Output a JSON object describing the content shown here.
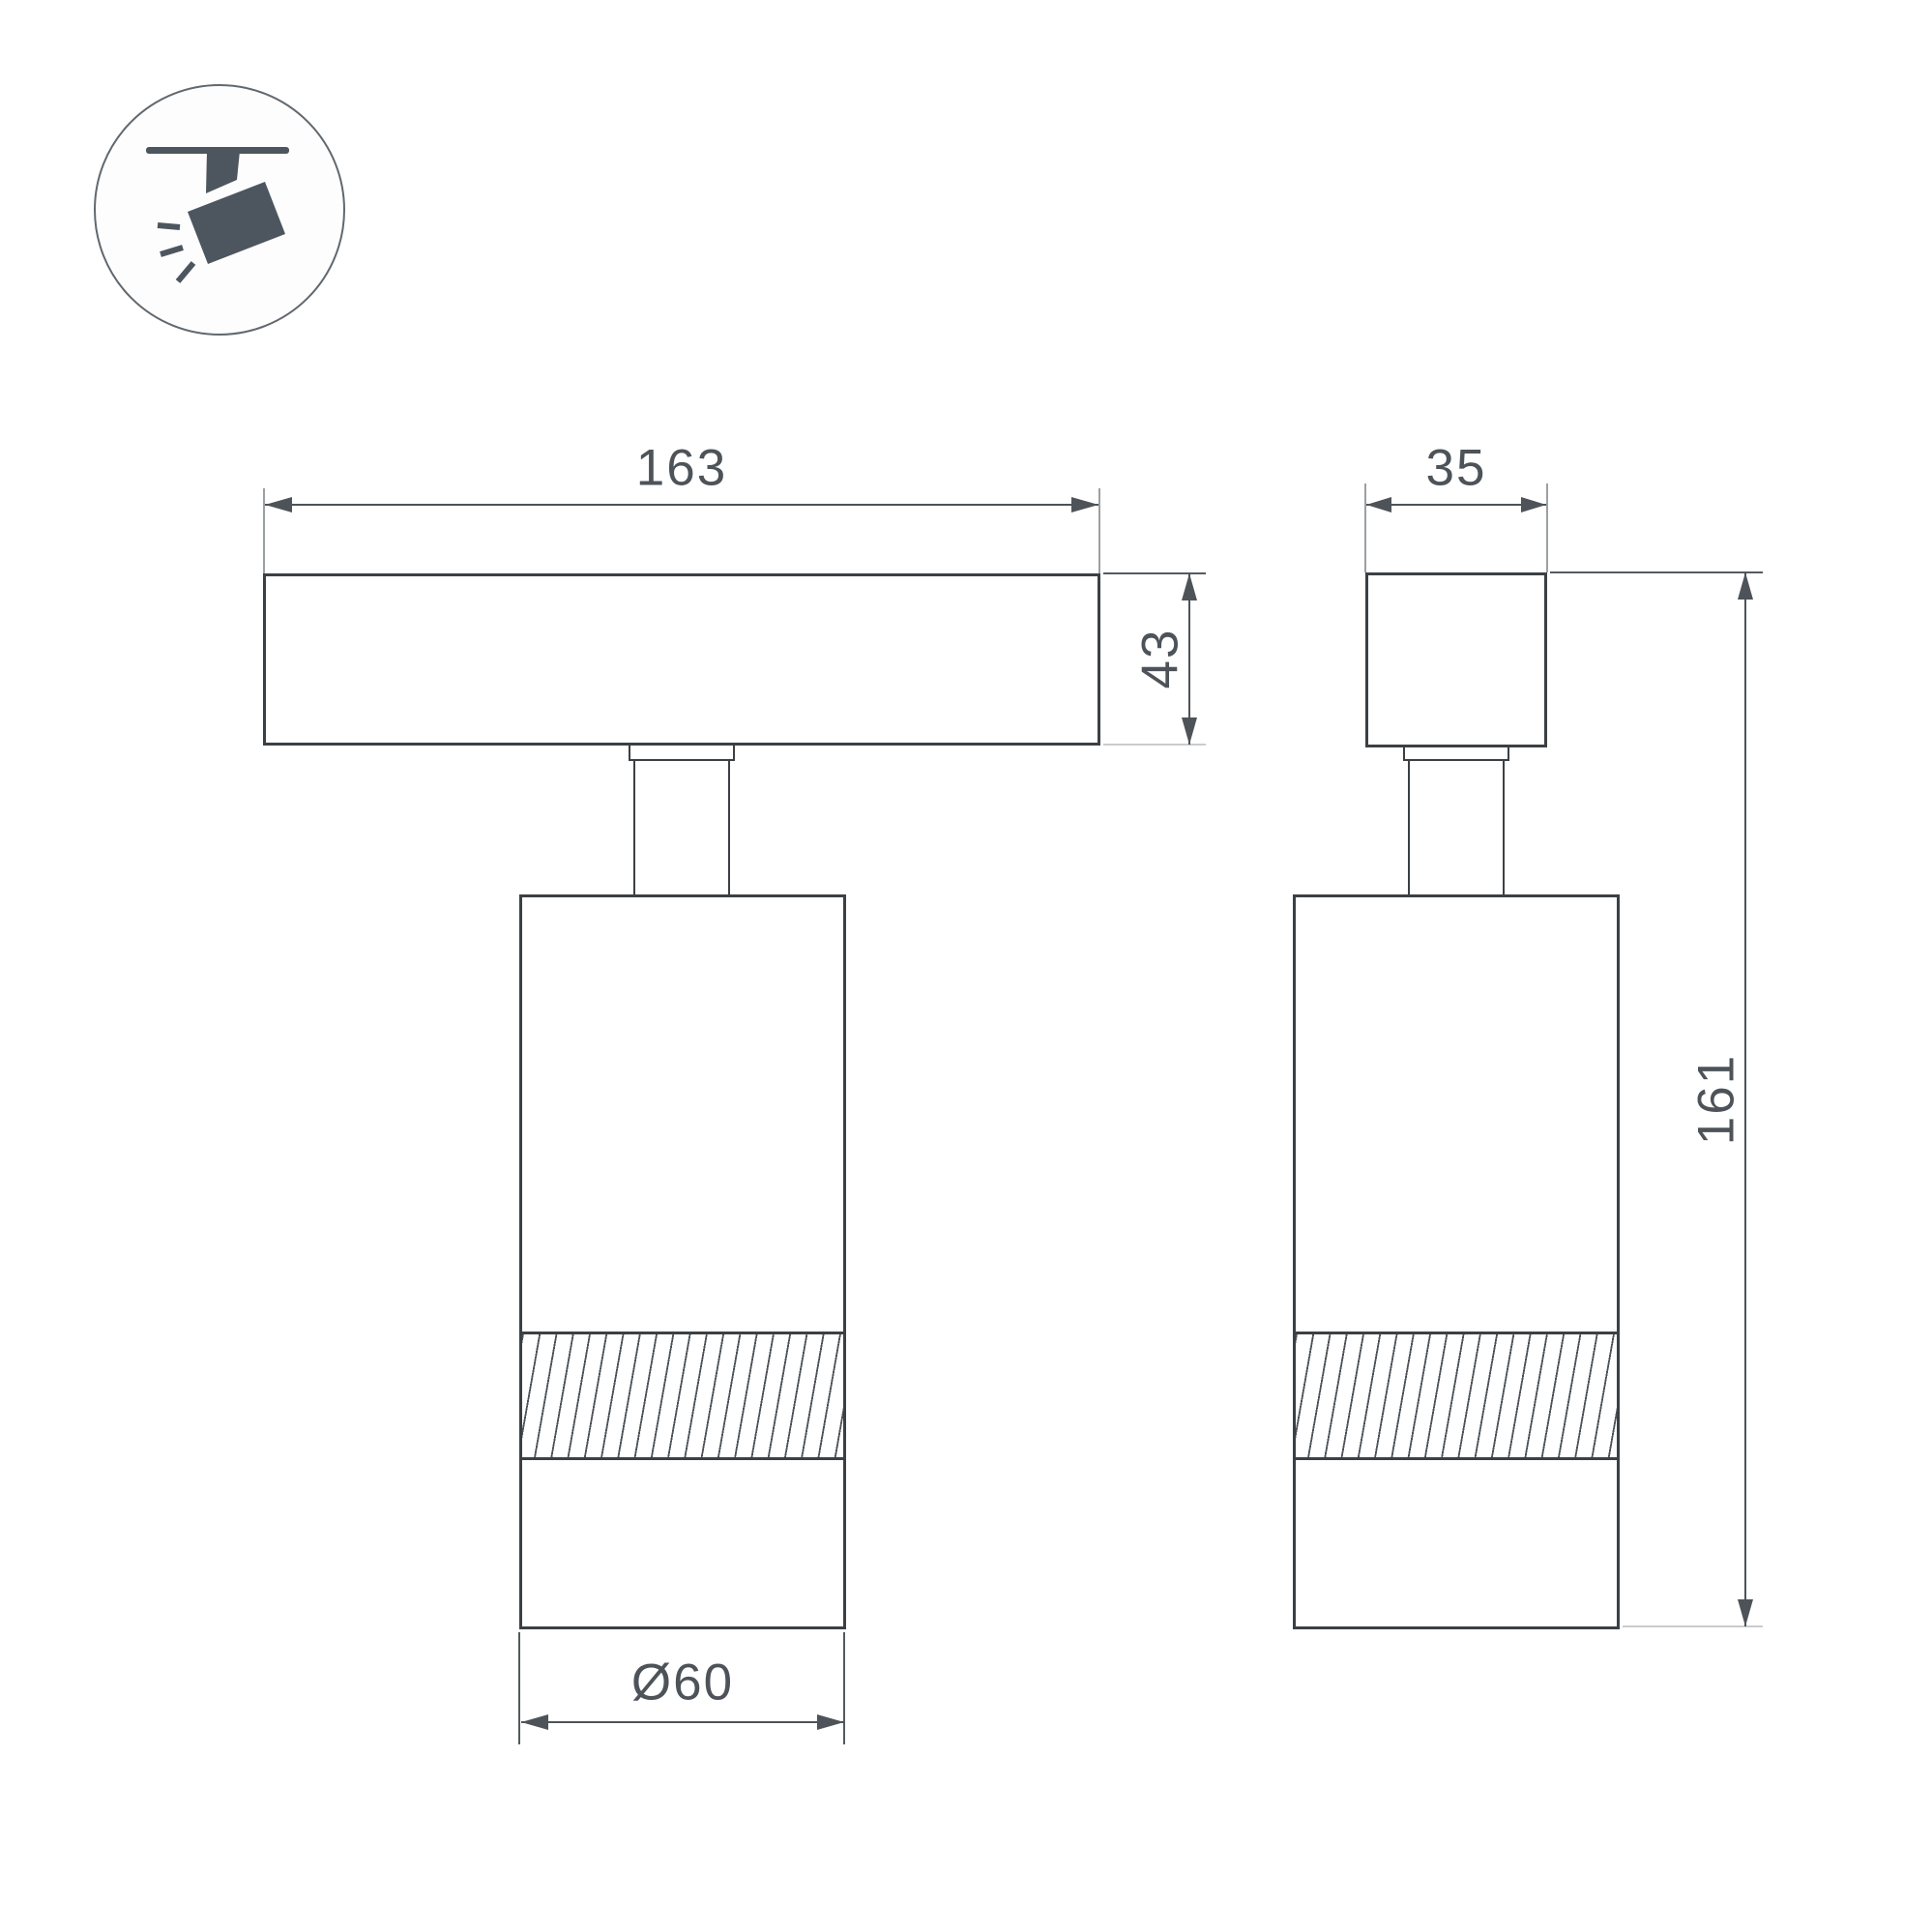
{
  "drawing": {
    "type": "technical-dimension-drawing",
    "subject": "track-mounted-spotlight",
    "icon": "track-spotlight-icon",
    "views": {
      "front": {
        "name": "front-view"
      },
      "side": {
        "name": "side-view"
      }
    },
    "dimensions": {
      "track_length": "163",
      "track_height": "43",
      "track_depth": "35",
      "total_height": "161",
      "body_diameter": "Ø60"
    },
    "colors": {
      "outline": "#3b4044",
      "dimension": "#4d5358",
      "extension_light": "#c9cccf",
      "extension_mid": "#9ba0a3",
      "extension_dark": "#555a5e",
      "icon_fill": "#4d565e",
      "background": "#ffffff"
    }
  }
}
